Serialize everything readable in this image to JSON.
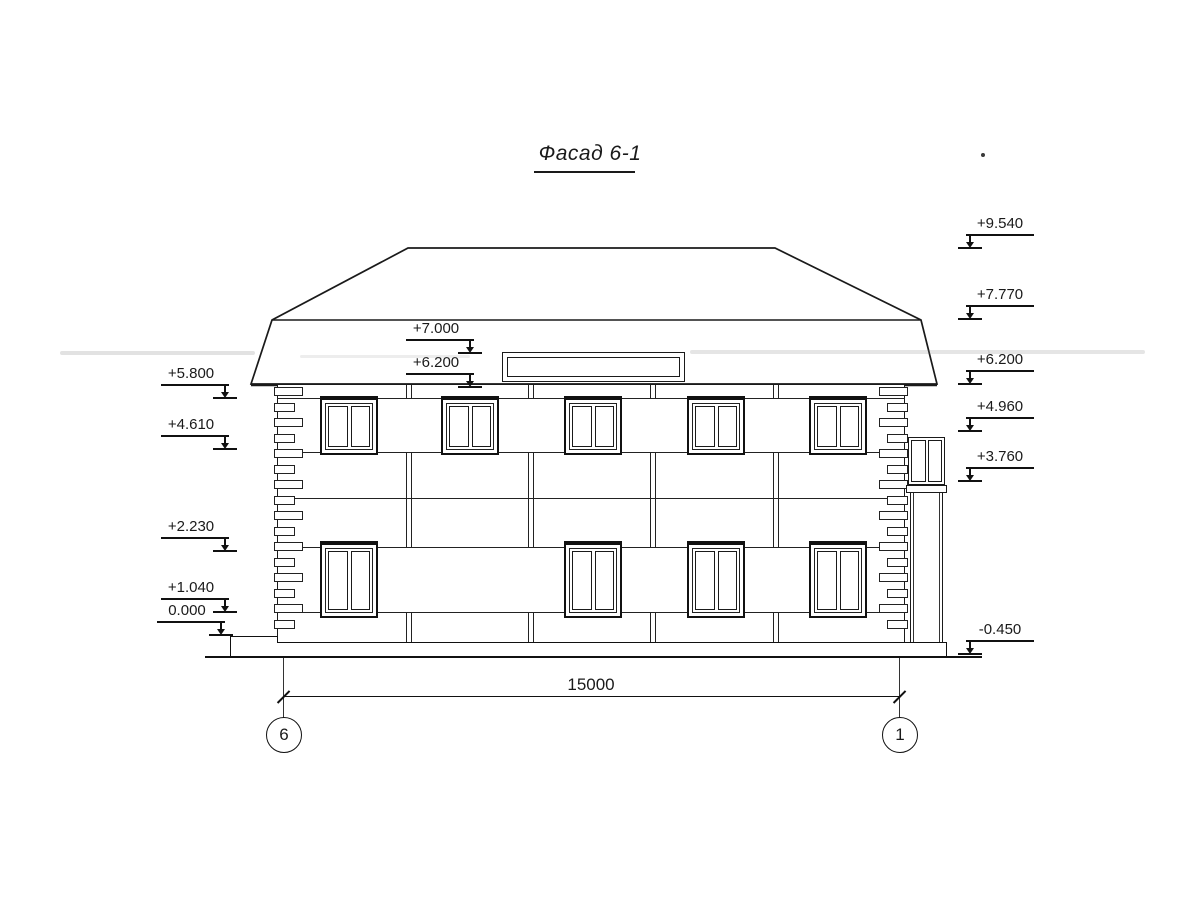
{
  "title": {
    "text": "Фасад 6-1"
  },
  "markers": {
    "left": [
      {
        "value": "+5.800"
      },
      {
        "value": "+4.610"
      },
      {
        "value": "+2.230"
      },
      {
        "value": "+1.040"
      },
      {
        "value": "0.000"
      }
    ],
    "middle": [
      {
        "value": "+7.000"
      },
      {
        "value": "+6.200"
      }
    ],
    "right": [
      {
        "value": "+9.540"
      },
      {
        "value": "+7.770"
      },
      {
        "value": "+6.200"
      },
      {
        "value": "+4.960"
      },
      {
        "value": "+3.760"
      },
      {
        "value": "-0.450"
      }
    ]
  },
  "dimension": {
    "value": "15000"
  },
  "grid": {
    "left": "6",
    "right": "1"
  },
  "colors": {
    "line": "#1a1a1a",
    "paper": "#ffffff"
  }
}
